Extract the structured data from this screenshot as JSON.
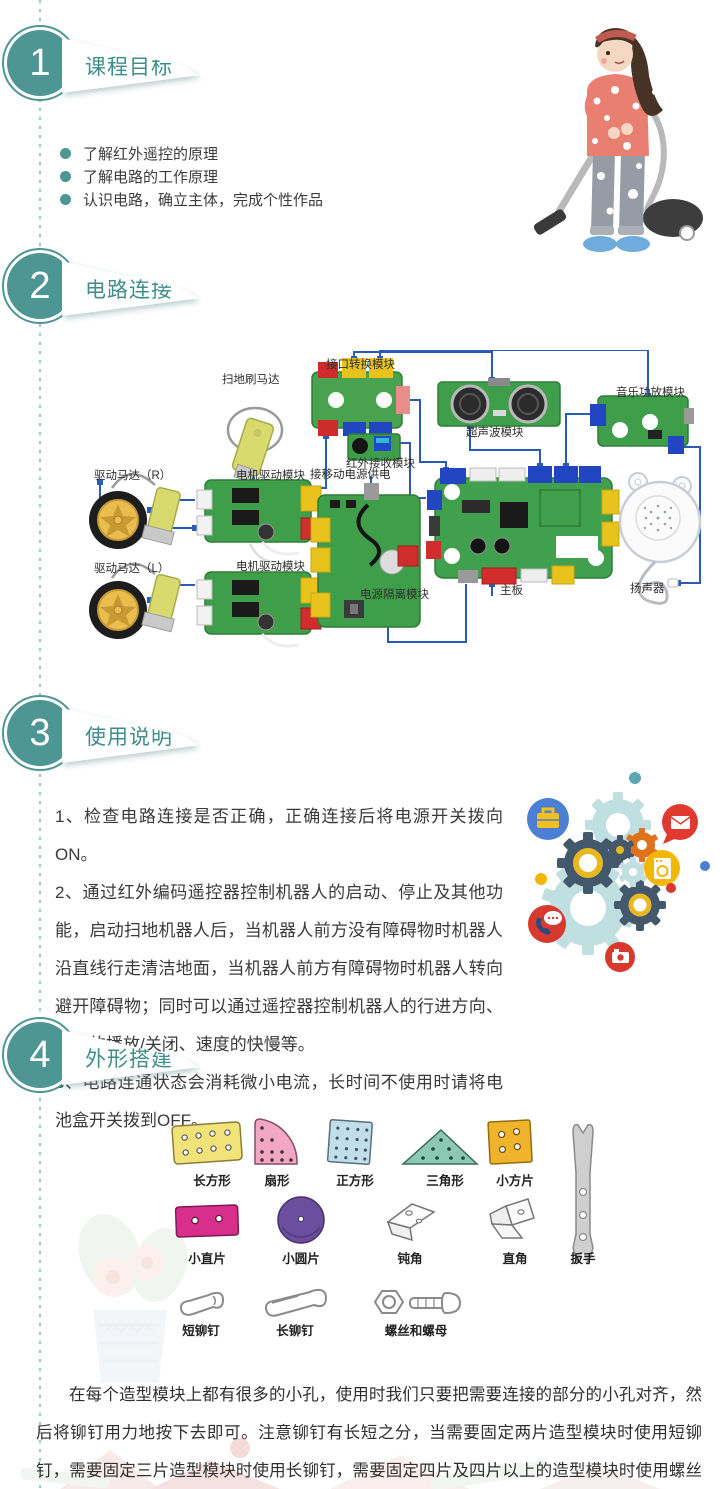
{
  "sections": [
    {
      "number": "1",
      "title": "课程目标"
    },
    {
      "number": "2",
      "title": "电路连接"
    },
    {
      "number": "3",
      "title": "使用说明"
    },
    {
      "number": "4",
      "title": "外形搭建"
    }
  ],
  "objectives": {
    "items": [
      "了解红外遥控的原理",
      "了解电路的工作原理",
      "认识电路，确立主体，完成个性作品"
    ]
  },
  "circuit": {
    "labels": {
      "sweep_motor": "扫地刷马达",
      "interface_module": "接口转换模块",
      "ultrasonic_module": "超声波模块",
      "music_amp_module": "音乐功放模块",
      "ir_receiver_module": "红外接收模块",
      "drive_motor_r": "驱动马达（R）",
      "motor_driver_module_1": "电机驱动模块",
      "power_input": "接移动电源供电",
      "drive_motor_l": "驱动马达（L）",
      "motor_driver_module_2": "电机驱动模块",
      "power_isolation_module": "电源隔离模块",
      "mainboard": "主板",
      "speaker": "扬声器"
    }
  },
  "usage": {
    "items": [
      "1、检查电路连接是否正确，正确连接后将电源开关拨向ON。",
      "2、通过红外编码遥控器控制机器人的启动、停止及其他功能，启动扫地机器人后，当机器人前方没有障碍物时机器人沿直线行走清洁地面，当机器人前方有障碍物时机器人转向避开障碍物；同时可以通过遥控器控制机器人的行进方向、音乐的播放/关闭、速度的快慢等。",
      "3、电路连通状态会消耗微小电流，长时间不使用时请将电池盒开关拨到OFF。"
    ]
  },
  "parts": {
    "row1": [
      {
        "label": "长方形"
      },
      {
        "label": "扇形"
      },
      {
        "label": "正方形"
      },
      {
        "label": "三角形"
      },
      {
        "label": "小方片"
      }
    ],
    "row2": [
      {
        "label": "小直片"
      },
      {
        "label": "小圆片"
      },
      {
        "label": "钝角"
      },
      {
        "label": "直角"
      },
      {
        "label": "扳手"
      }
    ],
    "row3": [
      {
        "label": "短铆钉"
      },
      {
        "label": "长铆钉"
      },
      {
        "label": "螺丝和螺母"
      }
    ]
  },
  "assembly_note": "在每个造型模块上都有很多的小孔，使用时我们只要把需要连接的部分的小孔对齐，然后将铆钉用力地按下去即可。注意铆钉有长短之分，当需要固定两片造型模块时使用短铆钉，需要固定三片造型模块时使用长铆钉，需要固定四片及四片以上的造型模块时使用螺丝和螺母来进行固定。",
  "colors": {
    "accent_teal": "#4e9693",
    "wire_blue": "#2a5bb8",
    "board_green": "#3e9e4a"
  },
  "illustrations": {
    "girl": "girl-vacuuming-illustration",
    "gears": "gears-and-icons-illustration"
  }
}
